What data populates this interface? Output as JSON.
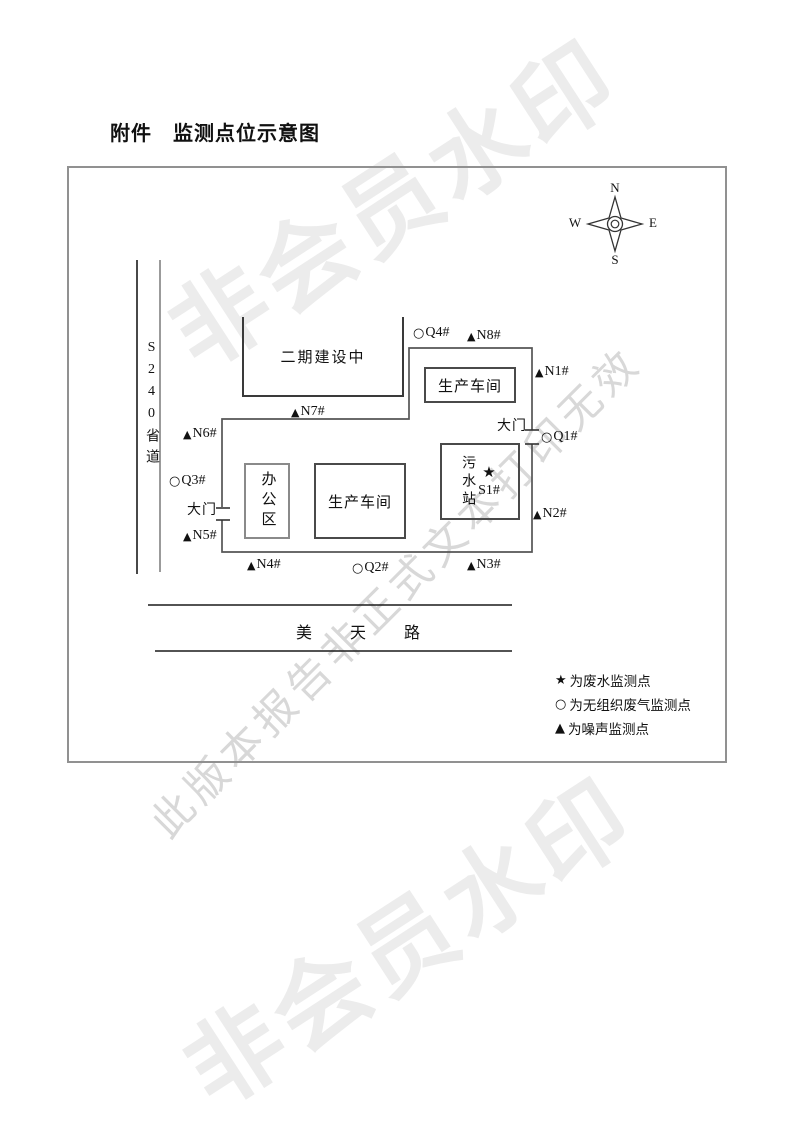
{
  "page": {
    "title": "附件　监测点位示意图"
  },
  "watermarks": {
    "member": "非会员水印",
    "notice": "此版本报告非正式文本打印无效"
  },
  "compass": {
    "n": "N",
    "s": "S",
    "w": "W",
    "e": "E"
  },
  "roads": {
    "left_road": "S240省道",
    "bottom_road": "美 天 路"
  },
  "buildings": {
    "phase2": "二期建设中",
    "workshop_north": "生产车间",
    "workshop_south": "生产车间",
    "office": "办公区",
    "sewage": "污水站"
  },
  "gates": {
    "right": "大门",
    "left": "大门"
  },
  "points": {
    "s1": {
      "marker": "★",
      "label": "S1#"
    },
    "n1": {
      "marker": "▲",
      "label": "N1#"
    },
    "n2": {
      "marker": "▲",
      "label": "N2#"
    },
    "n3": {
      "marker": "▲",
      "label": "N3#"
    },
    "n4": {
      "marker": "▲",
      "label": "N4#"
    },
    "n5": {
      "marker": "▲",
      "label": "N5#"
    },
    "n6": {
      "marker": "▲",
      "label": "N6#"
    },
    "n7": {
      "marker": "▲",
      "label": "N7#"
    },
    "n8": {
      "marker": "▲",
      "label": "N8#"
    },
    "q1": {
      "marker": "○",
      "label": "Q1#"
    },
    "q2": {
      "marker": "○",
      "label": "Q2#"
    },
    "q3": {
      "marker": "○",
      "label": "Q3#"
    },
    "q4": {
      "marker": "○",
      "label": "Q4#"
    }
  },
  "legend": [
    {
      "marker": "★",
      "label": "为废水监测点"
    },
    {
      "marker": "○",
      "label": "为无组织废气监测点"
    },
    {
      "marker": "▲",
      "label": "为噪声监测点"
    }
  ],
  "colors": {
    "frame": "#919191",
    "line_dark": "#1a1a1a",
    "boundary": "#555555",
    "road_gray": "#808080",
    "watermark_light": "#ececec",
    "watermark_mid": "#d8d8d8"
  }
}
